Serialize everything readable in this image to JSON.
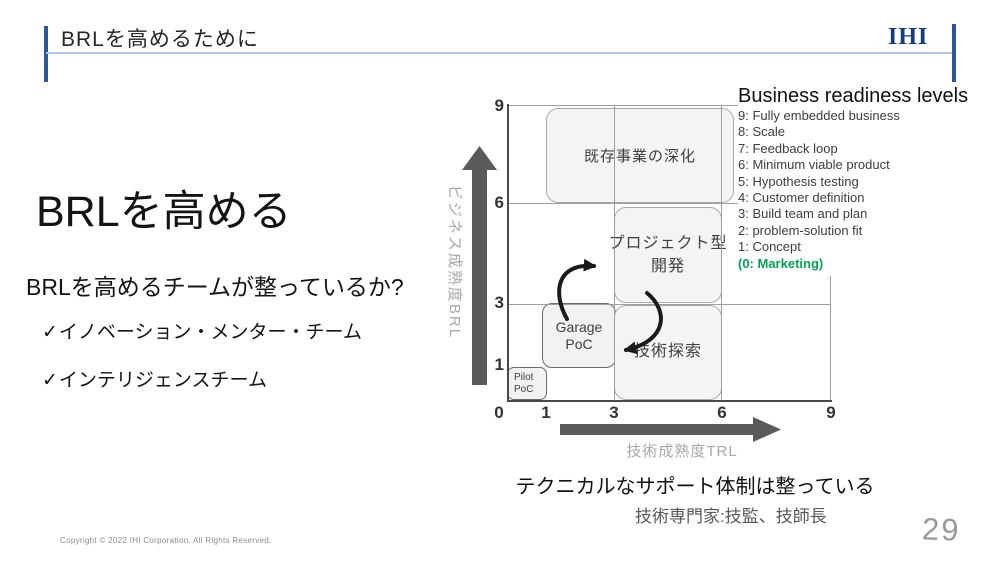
{
  "slide": {
    "header": {
      "title": "BRLを高めるために",
      "logo_text": "IHI"
    },
    "left": {
      "heading": "BRLを高める",
      "question": "BRLを高めるチームが整っているか?",
      "check_glyph": "✓",
      "checklist": [
        "イノベーション・メンター・チーム",
        "インテリジェンスチーム"
      ]
    },
    "brl": {
      "title": "Business readiness levels",
      "items": [
        "9: Fully embedded business",
        "8: Scale",
        "7: Feedback loop",
        "6: Minimum viable product",
        "5: Hypothesis testing",
        "4: Customer definition",
        "3: Build team and plan",
        "2: problem-solution fit",
        "1: Concept",
        "(0: Marketing)"
      ]
    },
    "captions": {
      "support": "テクニカルなサポート体制は整っている",
      "experts": "技術専門家:技監、技師長"
    },
    "footer": {
      "copyright": "Copyright © 2022 IHI Corporation. All Rights Reserved.",
      "page_number": "29"
    }
  },
  "chart_data": {
    "type": "region-diagram",
    "x_axis": {
      "title": "技術成熟度TRL",
      "tick_labels": [
        "0",
        "1",
        "3",
        "6",
        "9"
      ],
      "range": [
        0,
        9
      ]
    },
    "y_axis": {
      "title": "ビジネス成熟度BRL",
      "tick_labels": [
        "9",
        "6",
        "3",
        "1"
      ],
      "range": [
        0,
        9
      ]
    },
    "regions": [
      {
        "name": "existing-business-deepening",
        "lines": [
          "既存事業の深化"
        ],
        "x": [
          1,
          6
        ],
        "y": [
          6,
          9
        ]
      },
      {
        "name": "project-type-development",
        "lines": [
          "プロジェクト型",
          "開発"
        ],
        "x": [
          3,
          6
        ],
        "y": [
          3,
          6
        ]
      },
      {
        "name": "garage-poc",
        "lines": [
          "Garage",
          "PoC"
        ],
        "x": [
          1,
          3
        ],
        "y": [
          1,
          3
        ]
      },
      {
        "name": "technology-exploration",
        "lines": [
          "技術探索"
        ],
        "x": [
          3,
          6
        ],
        "y": [
          0,
          3
        ]
      },
      {
        "name": "pilot-poc",
        "lines": [
          "Pilot",
          "PoC"
        ],
        "x": [
          0,
          1
        ],
        "y": [
          0,
          1
        ]
      }
    ],
    "arrows": [
      {
        "from": "Garage PoC",
        "to": "プロジェクト型開発"
      },
      {
        "from": "プロジェクト型開発",
        "to": "Garage PoC"
      }
    ]
  },
  "colors": {
    "accent_blue": "#2c5898",
    "logo_blue": "#163e7c",
    "divider_blue": "#b3c6e7",
    "marketing_green": "#00A455",
    "axis_dark_gray": "#4a4a4a",
    "grid_gray": "#9e9e9e",
    "label_gray": "#a8a8a8",
    "box_fill": "#f4f4f4"
  }
}
